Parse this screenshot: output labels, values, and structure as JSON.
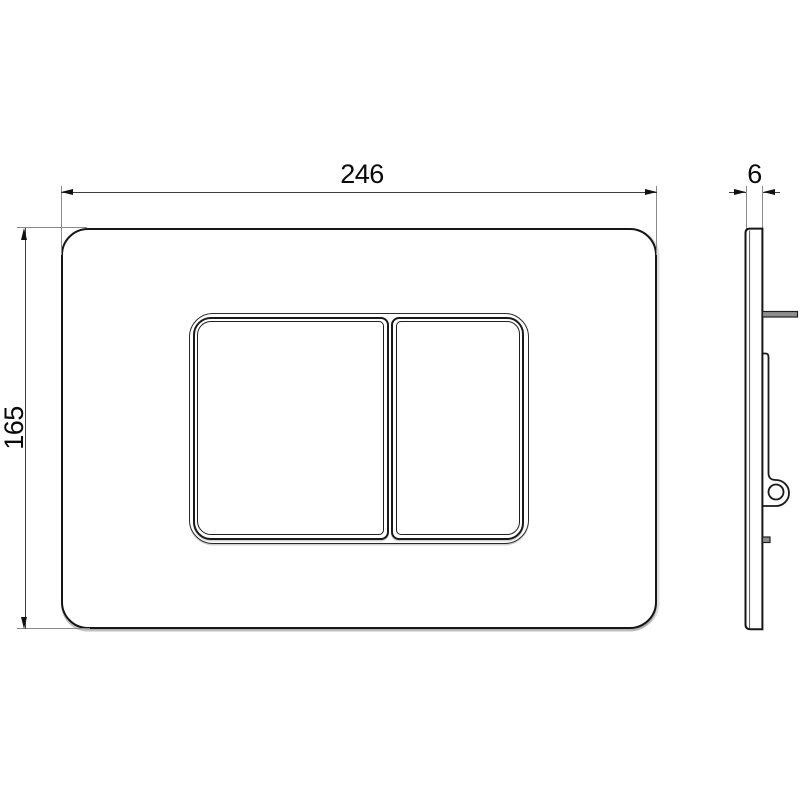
{
  "drawing": {
    "subject": "wall-mounted toilet flush plate technical drawing",
    "views": {
      "front": "front view with dual flush buttons",
      "side": "side profile view with mounting bracket, pin and clip"
    }
  },
  "dimensions": {
    "plate_width": "246",
    "plate_height": "165",
    "plate_thickness": "6"
  },
  "colors": {
    "background": "#ffffff",
    "outline": "#161616",
    "dimension_line": "#3f3f3f",
    "extension_line": "#8a8a8a",
    "metal_part_fill": "#8f8f8f"
  }
}
